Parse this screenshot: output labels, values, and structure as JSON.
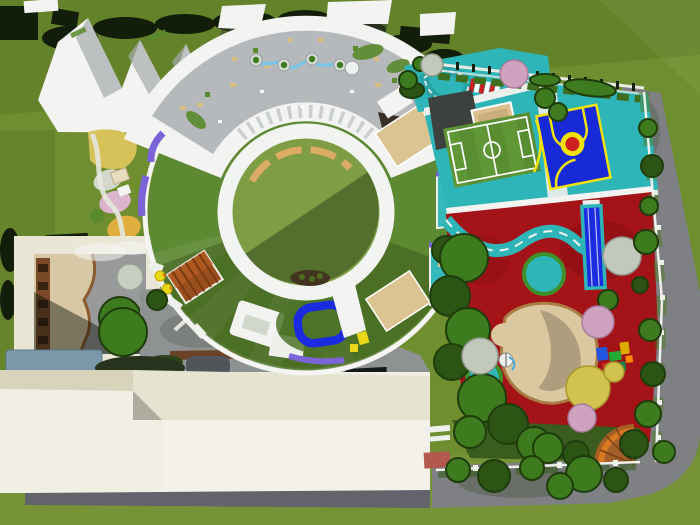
{
  "scene": {
    "description": "aerial-3d-rendering-of-kindergarten-campus-site-plan",
    "canvas": {
      "width": 700,
      "height": 525
    },
    "palette": {
      "grass": "#6f8e2f",
      "grass_dark": "#5a7a24",
      "road": "#7e8083",
      "under_strip": "#63646b",
      "cream_face": "#f1efe3",
      "cream_face2": "#f4f2e8",
      "cream_roof": "#d8d4bc",
      "cream_roof2": "#e6e3d1",
      "notch_gray": "#aeac9e",
      "brick_red": "#b2584e",
      "roof_white": "#f3f4f1",
      "roof_shade": "#a7abad",
      "terrace_gray": "#b6b9bb",
      "skylight_gray": "#c9cfcb",
      "lawn_ring": "#5d8933",
      "lawn_dark": "#4e7428",
      "courtyard_green": "#7e9d45",
      "bench_tan": "#dcab64",
      "planter_soil": "#41351f",
      "loop_blue": "#1b2ce0",
      "ramp_purple": "#7a64d8",
      "deck_wood": "#9a5c2b",
      "deck_wood_line": "#7a4620",
      "deck_tan": "#dcc392",
      "terrace_teal": "#35b9ba",
      "track_teal": "#2eb5b7",
      "track_teal_dark": "#27a3a5",
      "field_green": "#5f9636",
      "court_blue": "#1829d8",
      "court_yellow": "#f2e20c",
      "court_red": "#cc1f1f",
      "play_red": "#a41318",
      "play_red_dark": "#8e0f13",
      "sand": "#dcc8a0",
      "sand_edge": "#a97c44",
      "sandbox_tan": "#dcc090",
      "tarmac_dark": "#3d413d",
      "garden_dark": "#3a5c1e",
      "tree_green": "#3e7a1e",
      "tree_green_dark": "#2c5414",
      "tree_rim": "#1e3c0c",
      "tree_pink": "#cfa3bf",
      "tree_pale": "#c9cec2",
      "tree_white": "#c2c8bb",
      "tree_yellow": "#d2c24e",
      "hedge_dark": "#121d0a",
      "flower_yellow": "#d6c258",
      "flower_orange": "#dfae3e",
      "flower_pink": "#ec92c2",
      "flower_pink2": "#f0a8cc",
      "flower_white": "#d3d8cb",
      "path_white": "#e6e7e0",
      "water_blue": "#7ac4e4",
      "canopy_slate": "#7b99aa",
      "shelf_brown": "#7a4a28",
      "patio_tan": "#d8c8a6",
      "concrete": "#98999a",
      "paving": "#8e9292",
      "paving_dark": "#70756f",
      "bench_wood": "#6b4226",
      "hut_red": "#9a4e1e",
      "hut_red_light": "#b25a22",
      "duck_yellow": "#e8d818",
      "line_white": "#ffffff",
      "fence_white": "#eef0ec",
      "furniture_tan": "#d9be82",
      "planter_green": "#5a8a2c",
      "slide_brown": "#a55f28",
      "slide_orange": "#d87820",
      "eq_blue": "#2255dd",
      "eq_green": "#22aa33",
      "eq_yellow": "#ddaa00",
      "eq_red": "#cc3322",
      "eq_teal": "#118844",
      "eq_orange": "#ff8800",
      "node_ring": "#d8dcd6",
      "white_circle": "#eef0ed"
    },
    "features": [
      "surrounding-lawn",
      "perimeter-road",
      "ring-classroom-building",
      "roof-terrace",
      "central-courtyard",
      "courtyard-lawn-ring",
      "zigzag-roof-building",
      "roof-monitors",
      "west-flower-garden",
      "red-tile-hut",
      "nursery-courtyard-building",
      "service-building",
      "soccer-field",
      "basketball-court",
      "tricycle-traffic-track",
      "red-rubber-playground",
      "winding-trike-road",
      "sand-pit",
      "lap-pool",
      "timber-fan-deck",
      "teal-balcony-terraces",
      "blue-play-loop",
      "tree-belt",
      "boundary-fence",
      "play-equipment",
      "spiral-slide"
    ]
  }
}
